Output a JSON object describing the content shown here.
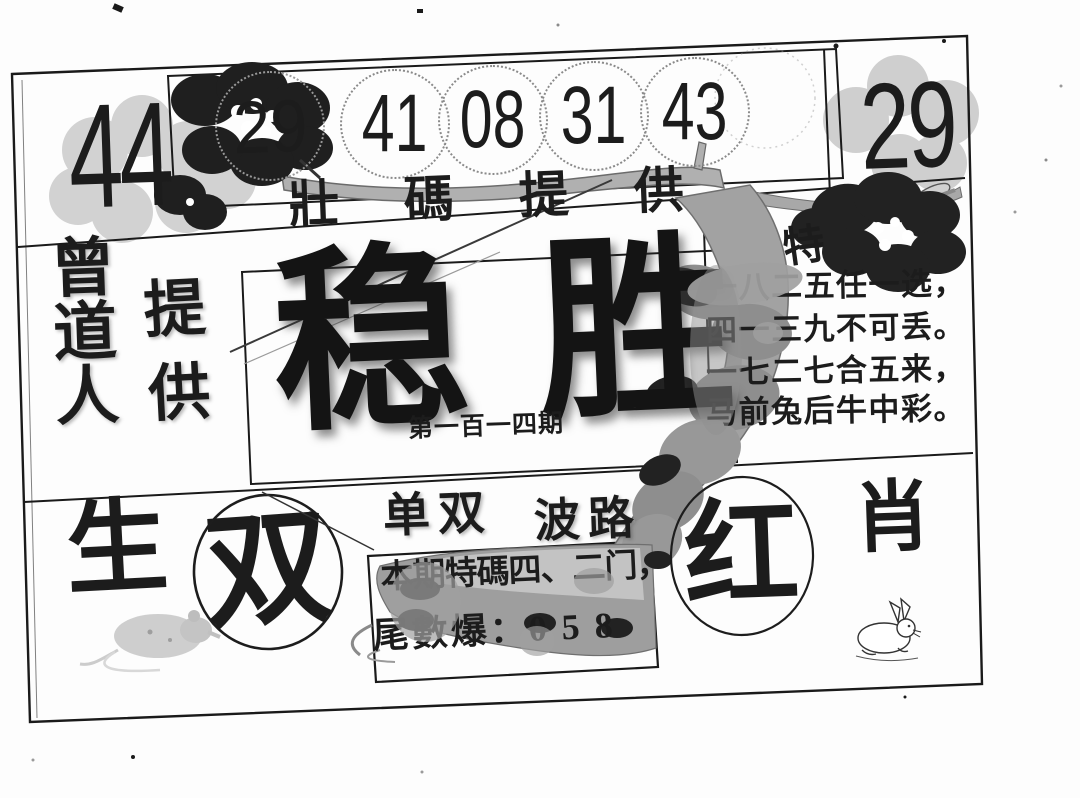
{
  "document": {
    "colors": {
      "ink": "#1c1c1c",
      "branch_gray": "#9a9a9a",
      "blossom_light_gray": "#d2d2d2",
      "blossom_dark": "#1f1f1f"
    },
    "top": {
      "big_left_number": "44",
      "blossom_number": "29",
      "circled_numbers": [
        "41",
        "08",
        "31",
        "43"
      ],
      "big_right_number": "29",
      "caption": "壯碼提供",
      "special_char": "特"
    },
    "left": {
      "provider": "曾道人",
      "provide": "提供"
    },
    "center": {
      "title": "稳胜",
      "issue_no": "第一百一四期"
    },
    "poem": {
      "line1": "一八二五任一选，",
      "line2": "四一三九不可丢。",
      "line3": "一七二七合五来，",
      "line4": "马前兔后牛中彩。"
    },
    "bottom": {
      "zodiac_char_left": "生",
      "circled_parity": "双",
      "parity_label": "单双",
      "wave_label": "波路",
      "tip_line1": "本期特碼四、二门，",
      "tip_line2": "尾數爆：0 5 8",
      "circled_color": "红",
      "zodiac_char_right": "肖"
    }
  }
}
